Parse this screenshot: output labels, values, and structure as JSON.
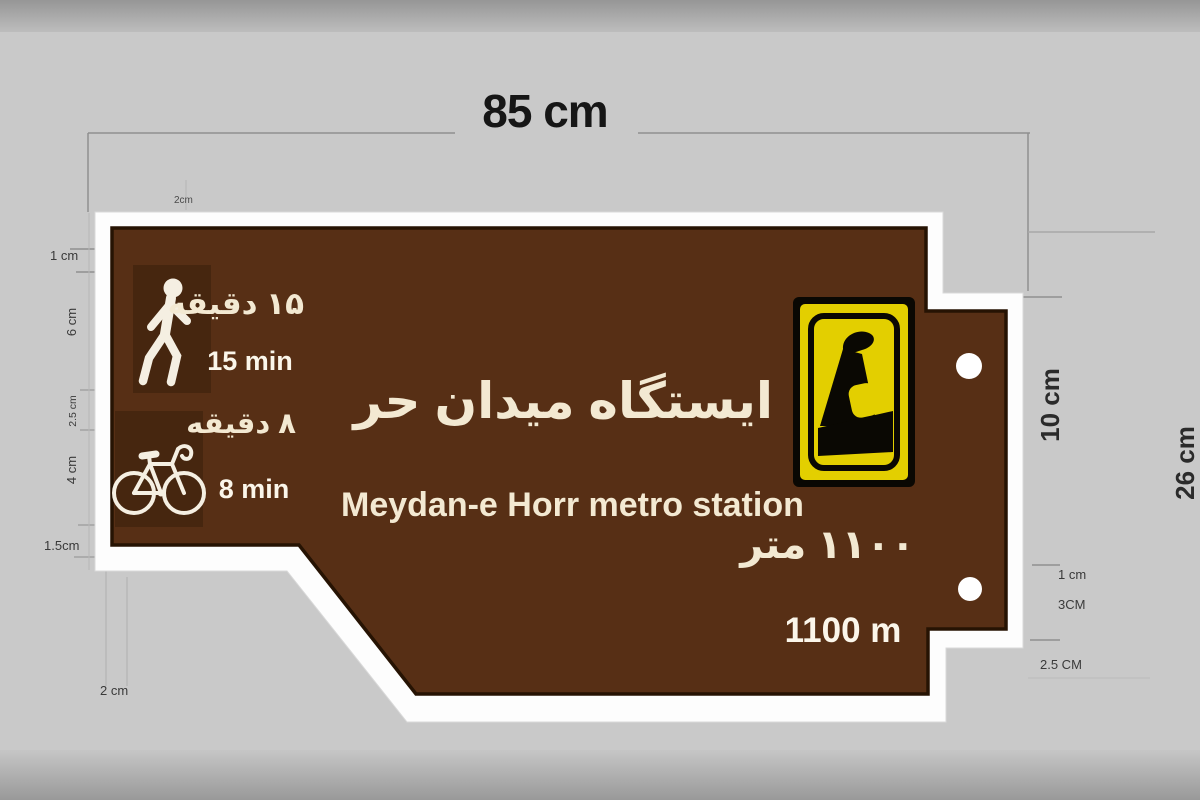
{
  "diagram": {
    "type": "sign-specification-drawing",
    "background_color": "#c9c9c9"
  },
  "dimensions": {
    "total_width": "85 cm",
    "top_offset_small": "2cm",
    "border_top": "1 cm",
    "walk_icon_box_height": "6 cm",
    "icon_gap": "2.5 cm",
    "bike_icon_box_height": "4 cm",
    "bottom_gap": "1.5cm",
    "border_bottom": "2 cm",
    "tab_height": "10 cm",
    "total_height": "26 cm",
    "tab_border": "1 cm",
    "hole_offset": "3CM",
    "tab_bottom_offset": "2.5 CM"
  },
  "sign": {
    "station_name_fa": "ایستگاه میدان حر",
    "station_name_en": "Meydan-e Horr metro station",
    "walk_time_fa": "۱۵ دقیقه",
    "walk_time_en": "15 min",
    "bike_time_fa": "۸ دقیقه",
    "bike_time_en": "8 min",
    "distance_fa": "۱۱۰۰ متر",
    "distance_en": "1100 m",
    "colors": {
      "panel_brown": "#572f15",
      "icon_box_brown": "#46260f",
      "border_white": "#fdfdfd",
      "logo_yellow": "#e3cf00",
      "logo_black": "#0a0803",
      "text_cream": "#f3e9d2"
    },
    "icons": [
      "pedestrian-icon",
      "bicycle-icon",
      "tehran-metro-logo-icon",
      "mounting-hole"
    ]
  }
}
